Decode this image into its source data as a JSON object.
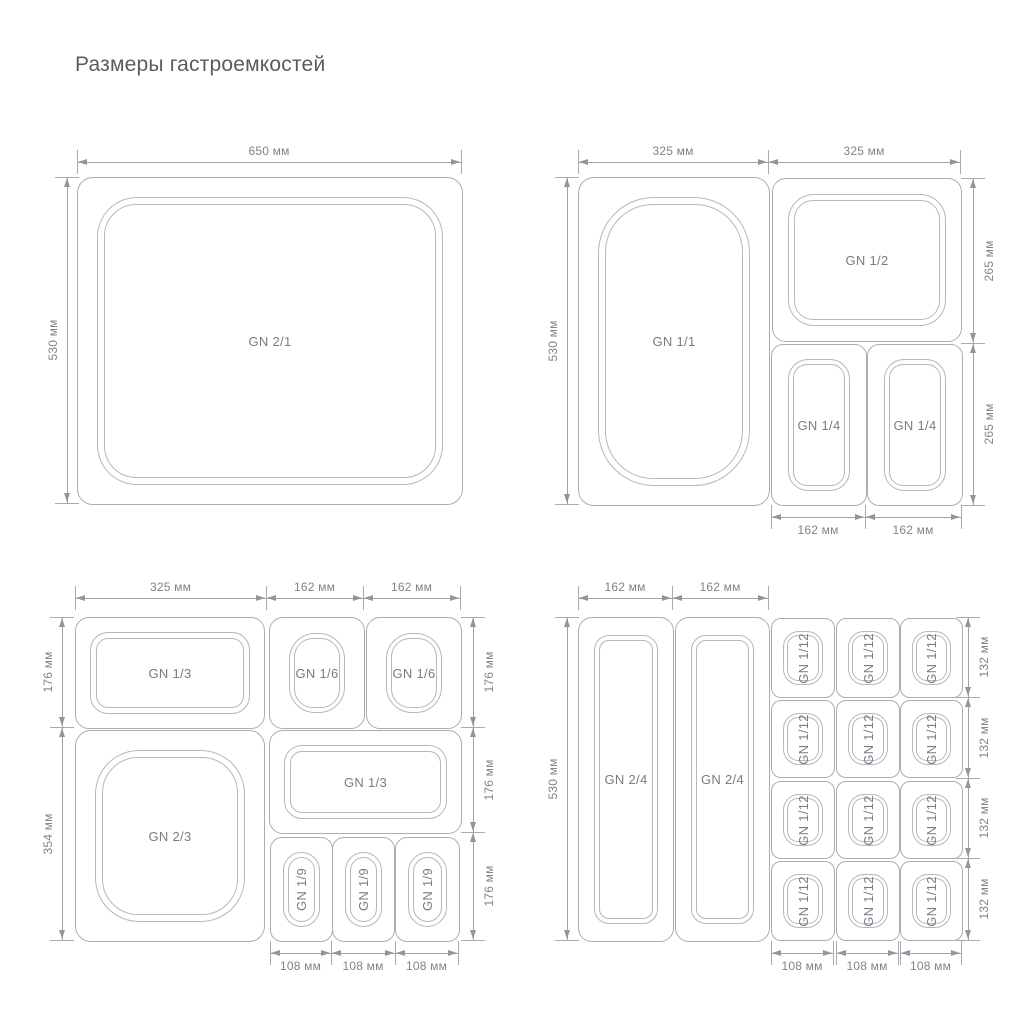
{
  "title": "Размеры гастроемкостей",
  "colors": {
    "container_line": "#a9aeb5",
    "dimension_line": "#9ba2a9",
    "label_text": "#767d85",
    "dimension_text": "#7d848c",
    "title_text": "#575d64",
    "background": "#ffffff"
  },
  "panels": {
    "gn21": {
      "containers": [
        {
          "label": "GN 2/1"
        }
      ],
      "dims": {
        "top": [
          "650 мм"
        ],
        "left": [
          "530 мм"
        ]
      }
    },
    "gn11": {
      "containers": [
        {
          "label": "GN 1/1"
        },
        {
          "label": "GN 1/2"
        },
        {
          "label": "GN 1/4"
        },
        {
          "label": "GN 1/4"
        }
      ],
      "dims": {
        "top": [
          "325 мм",
          "325 мм"
        ],
        "left": [
          "530 мм"
        ],
        "right": [
          "265 мм",
          "265 мм"
        ],
        "bottom": [
          "162 мм",
          "162 мм"
        ]
      }
    },
    "gn13": {
      "containers": [
        {
          "label": "GN 1/3"
        },
        {
          "label": "GN 1/6"
        },
        {
          "label": "GN 1/6"
        },
        {
          "label": "GN 2/3"
        },
        {
          "label": "GN 1/3"
        },
        {
          "label": "GN 1/9"
        },
        {
          "label": "GN 1/9"
        },
        {
          "label": "GN 1/9"
        }
      ],
      "dims": {
        "top": [
          "325 мм",
          "162 мм",
          "162 мм"
        ],
        "left": [
          "176 мм",
          "354 мм"
        ],
        "right": [
          "176 мм",
          "176 мм",
          "176 мм"
        ],
        "bottom": [
          "108 мм",
          "108 мм",
          "108 мм"
        ]
      }
    },
    "gn24": {
      "containers": [
        {
          "label": "GN 2/4"
        },
        {
          "label": "GN 2/4"
        },
        {
          "label": "GN 1/12"
        },
        {
          "label": "GN 1/12"
        },
        {
          "label": "GN 1/12"
        },
        {
          "label": "GN 1/12"
        },
        {
          "label": "GN 1/12"
        },
        {
          "label": "GN 1/12"
        },
        {
          "label": "GN 1/12"
        },
        {
          "label": "GN 1/12"
        },
        {
          "label": "GN 1/12"
        },
        {
          "label": "GN 1/12"
        },
        {
          "label": "GN 1/12"
        },
        {
          "label": "GN 1/12"
        }
      ],
      "dims": {
        "top": [
          "162 мм",
          "162 мм"
        ],
        "left": [
          "530 мм"
        ],
        "right": [
          "132 мм",
          "132 мм",
          "132 мм",
          "132 мм"
        ],
        "bottom": [
          "108 мм",
          "108 мм",
          "108 мм"
        ]
      }
    }
  }
}
